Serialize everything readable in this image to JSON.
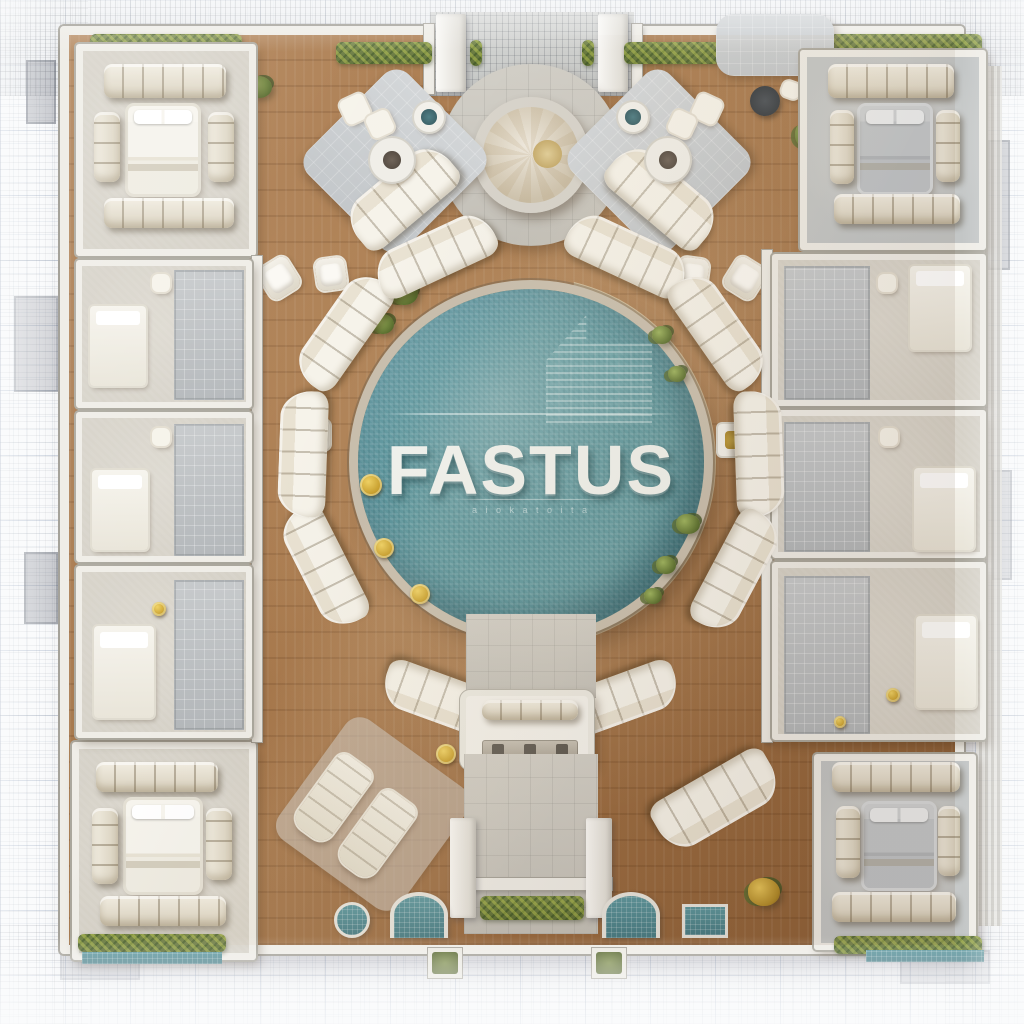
{
  "branding": {
    "pool_label": "FASTUS",
    "pool_tagline_illegible": "a i o k a t o i t a"
  },
  "palette": {
    "paper": "#fafbfc",
    "grid_line": "#b9c4d4",
    "sketch_line": "#6f7480",
    "wall_white": "#efede7",
    "wood_deck": "#a5764a",
    "wood_deck_dark": "#8a5d36",
    "stone_path": "#d2cfc7",
    "pool_teal": "#55909a",
    "pool_teal_dark": "#3f6f78",
    "pool_rim_stone": "#c9bfae",
    "sofa_cream": "#f2eee2",
    "sofa_shadow": "#d8d0bd",
    "carpet_beige": "#d6d2c8",
    "carpet_gray": "#c3c6c6",
    "bed_white": "#f5f3ec",
    "bed_gray": "#c3c7ca",
    "hedge_green": "#5d6e36",
    "accent_gold": "#c49a28",
    "marble_white": "#efe9dd"
  }
}
